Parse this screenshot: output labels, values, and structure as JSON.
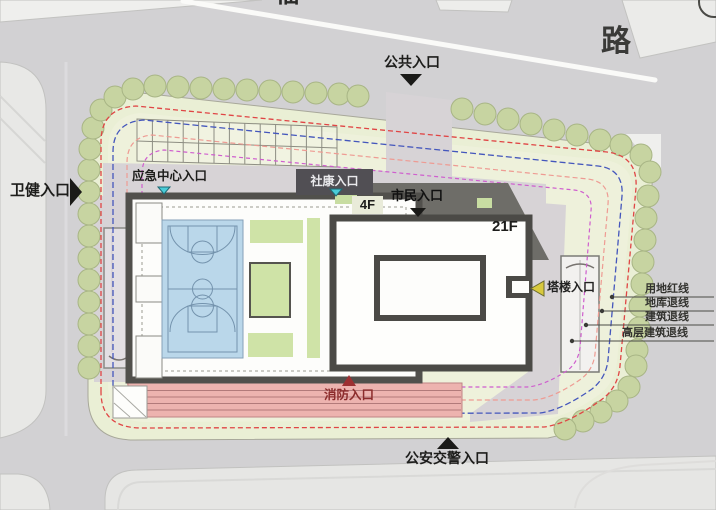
{
  "plan": {
    "road_name_partial": "福",
    "road_name": "路",
    "entrances": {
      "public": {
        "label": "公共入口",
        "arrow": "down",
        "arrow_color": "#1a1a18"
      },
      "health": {
        "label": "卫健入口",
        "arrow": "right",
        "arrow_color": "#1a1a18"
      },
      "emergency": {
        "label": "应急中心入口",
        "arrow": "down",
        "arrow_color": "#49ccd8"
      },
      "community": {
        "label": "社康入口",
        "arrow": "down",
        "arrow_color": "#49ccd8"
      },
      "citizen": {
        "label": "市民入口",
        "arrow": "down",
        "arrow_color": "#1a1a18"
      },
      "tower": {
        "label": "塔楼入口",
        "arrow": "left",
        "arrow_color": "#d8c93e"
      },
      "fire": {
        "label": "消防入口",
        "arrow": "up",
        "arrow_color": "#9c3032"
      },
      "police": {
        "label": "公安交警入口",
        "arrow": "up",
        "arrow_color": "#1a1a18"
      }
    },
    "buildings": {
      "podium_floors": "4F",
      "tower_floors": "21F"
    },
    "legend": {
      "items": [
        {
          "label": "用地红线",
          "color": "#e04545",
          "style": "dashed"
        },
        {
          "label": "地库退线",
          "color": "#4456bc",
          "style": "dashed"
        },
        {
          "label": "建筑退线",
          "color": "#ee9b93",
          "style": "dashed"
        },
        {
          "label": "高层建筑退线",
          "color": "#cf5ece",
          "style": "dashed"
        }
      ]
    }
  }
}
